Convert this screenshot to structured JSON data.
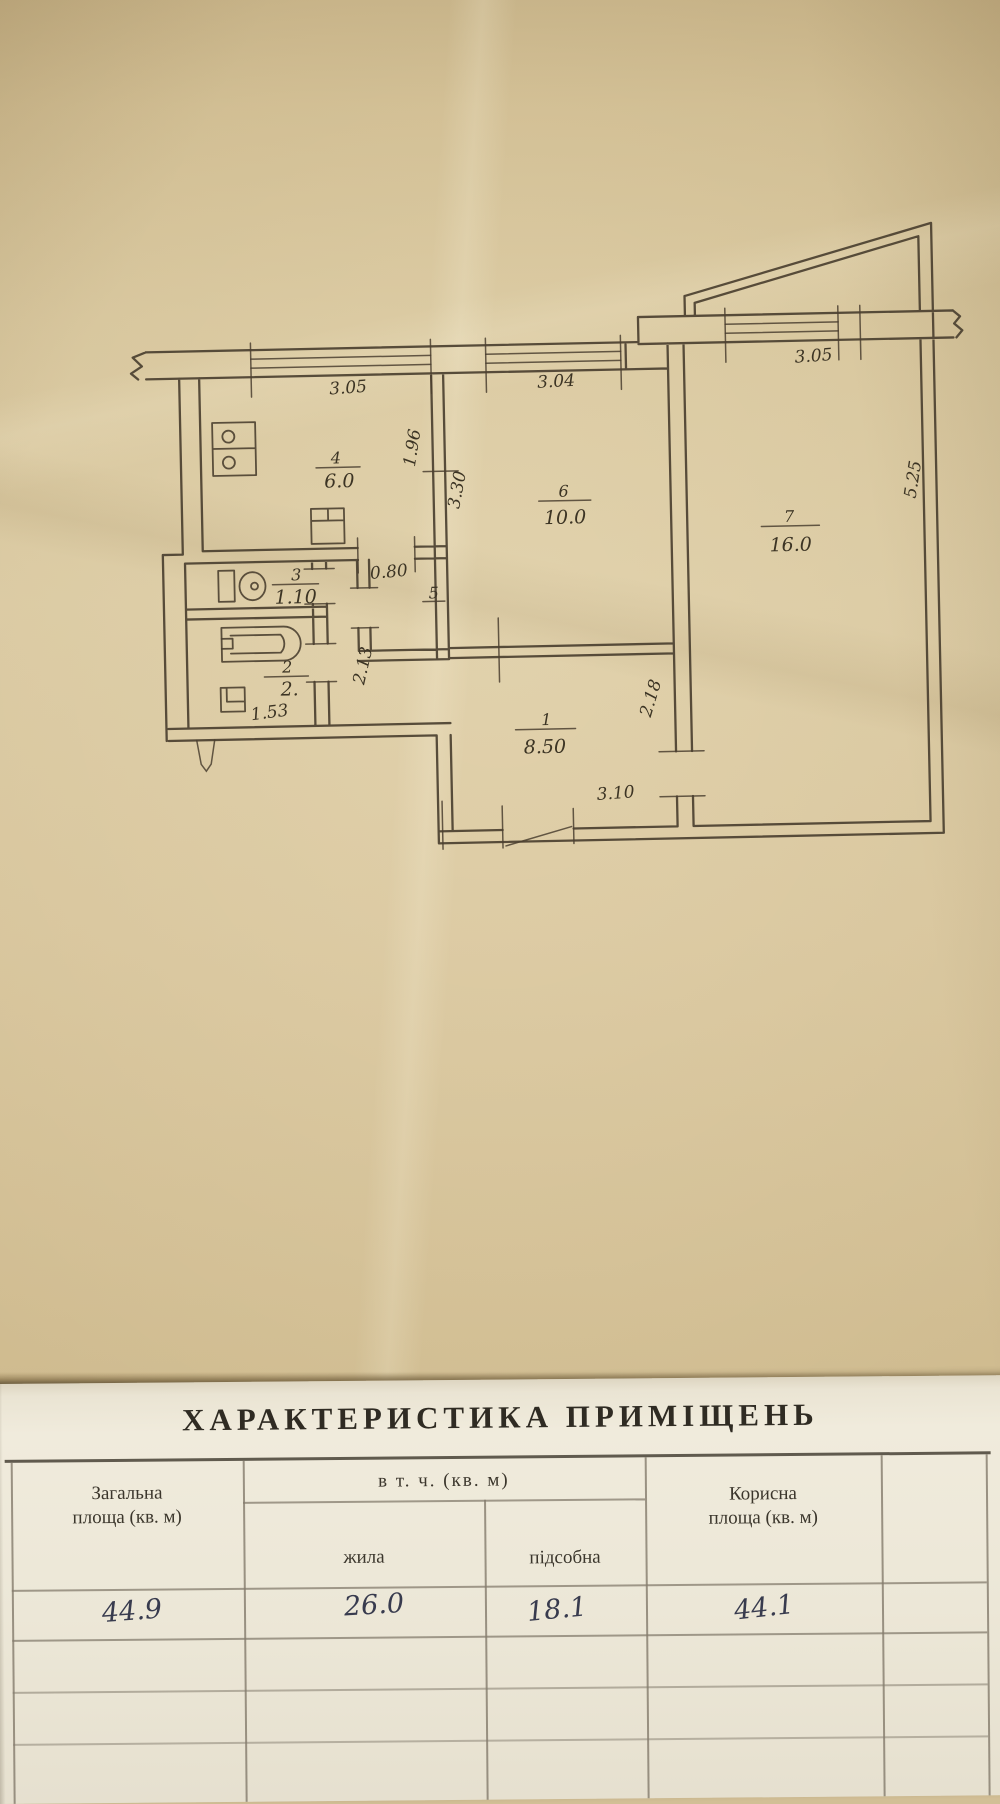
{
  "plan": {
    "rooms": {
      "kitchen": {
        "num": "4",
        "area": "6.0"
      },
      "room6": {
        "num": "6",
        "area": "10.0"
      },
      "room7": {
        "num": "7",
        "area": "16.0"
      },
      "toilet": {
        "num": "3",
        "area": "1.10"
      },
      "bath": {
        "num": "2",
        "area": "2."
      },
      "hall": {
        "num": "1",
        "area": "8.50"
      },
      "closet": {
        "num": "5"
      }
    },
    "dims": {
      "win_left": "3.05",
      "win_mid": "3.04",
      "win_right": "3.05",
      "kitchen_depth": "1.96",
      "room6_depth": "3.30",
      "room7_depth": "5.25",
      "kitchen_door": "0.80",
      "bath_wall": "2.13",
      "hall_wall": "2.18",
      "bath_width": "1.53",
      "hall_width": "3.10"
    }
  },
  "table": {
    "title": "ХАРАКТЕРИСТИКА ПРИМІЩЕНЬ",
    "group_header": "в т. ч. (кв. м)",
    "columns": {
      "total": "Загальна площа (кв. м)",
      "living": "жила",
      "aux": "підсобна",
      "useful": "Корисна площа (кв. м)"
    },
    "values": {
      "total": "44.9",
      "living": "26.0",
      "aux": "18.1",
      "useful": "44.1"
    }
  }
}
